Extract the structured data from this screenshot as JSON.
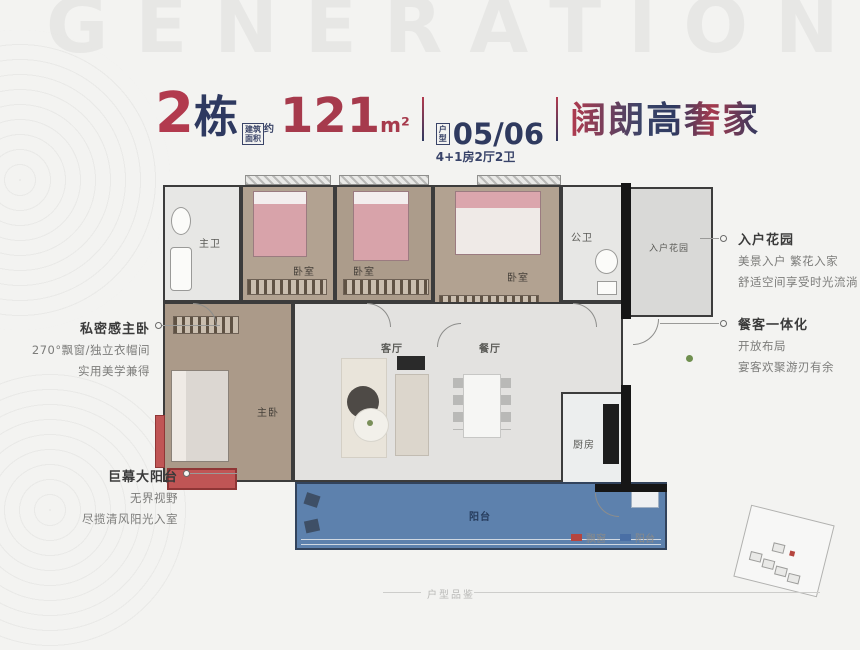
{
  "page": {
    "watermark": "GENERATION",
    "footer_label": "户型品鉴"
  },
  "header": {
    "building_number": "2",
    "building_suffix": "栋",
    "area_box_line1": "建筑",
    "area_box_line2": "面积",
    "area_approx": "约",
    "area_value": "121",
    "area_unit": "m²",
    "unit_box_line1": "户",
    "unit_box_line2": "型",
    "unit_numbers": "05/06",
    "unit_layout": "4+1房2厅2卫",
    "slogan": "阔朗高奢家"
  },
  "floorplan": {
    "rooms": {
      "master_bath": "主卫",
      "bedroom1": "卧室",
      "bedroom2": "卧室",
      "bedroom3": "卧室",
      "public_bath": "公卫",
      "entry_garden": "入户花园",
      "living": "客厅",
      "dining": "餐厅",
      "master_bedroom": "主卧",
      "kitchen": "厨房",
      "balcony": "阳台"
    }
  },
  "annotations": {
    "left": [
      {
        "title": "私密感主卧",
        "lines": [
          "270°飘窗/独立衣帽间",
          "实用美学兼得"
        ]
      },
      {
        "title": "巨幕大阳台",
        "lines": [
          "无界视野",
          "尽揽清风阳光入室"
        ]
      }
    ],
    "right": [
      {
        "title": "入户花园",
        "lines": [
          "美景入户 繁花入家",
          "舒适空间享受时光流淌"
        ]
      },
      {
        "title": "餐客一体化",
        "lines": [
          "开放布局",
          "宴客欢聚游刃有余"
        ]
      }
    ]
  },
  "legend": [
    {
      "label": "飘窗",
      "color": "#b5453e"
    },
    {
      "label": "阳台",
      "color": "#4a6fa5"
    }
  ],
  "colors": {
    "accent_red": "#b23a4e",
    "accent_navy": "#2e3960",
    "balcony_blue": "#5d81ad",
    "bay_window_red": "#c05555",
    "wood_floor": "#b09f8d",
    "wall": "#3c3c3c",
    "background": "#f3f3f1"
  }
}
